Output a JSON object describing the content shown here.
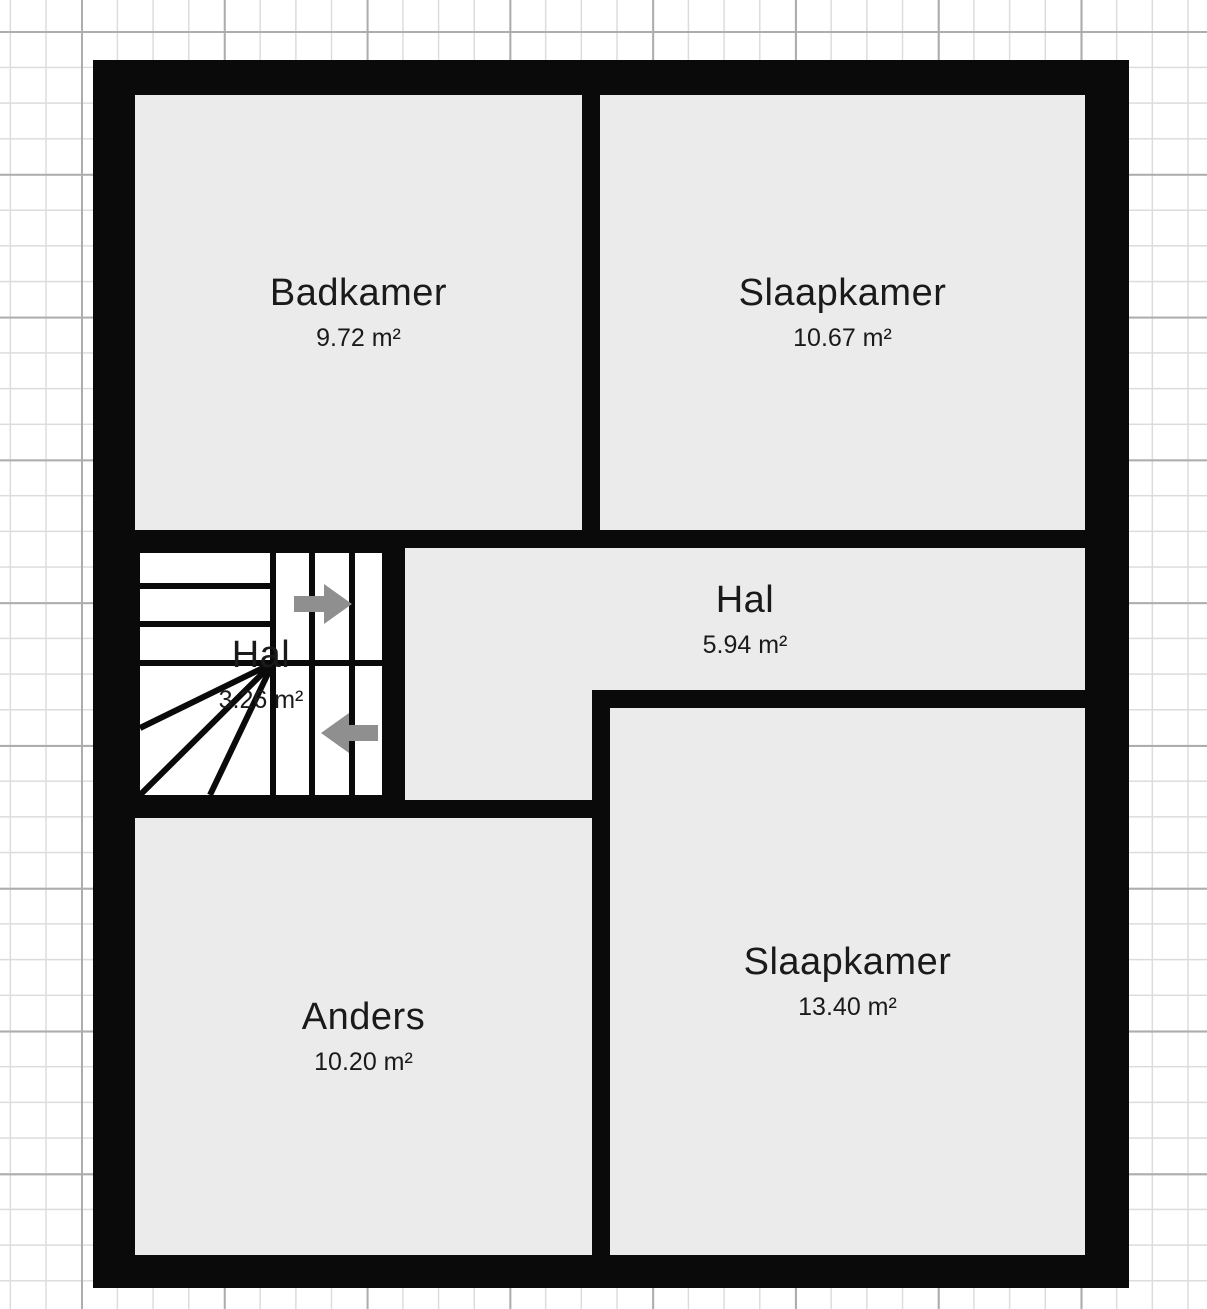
{
  "plan": {
    "kind": "floor-plan",
    "area_unit": "m²"
  },
  "rooms": [
    {
      "id": "badkamer",
      "name": "Badkamer",
      "area": "9.72 m²"
    },
    {
      "id": "slaapkamer-top",
      "name": "Slaapkamer",
      "area": "10.67 m²"
    },
    {
      "id": "hal-stairs",
      "name": "Hal",
      "area": "3.26 m²"
    },
    {
      "id": "hal",
      "name": "Hal",
      "area": "5.94 m²"
    },
    {
      "id": "anders",
      "name": "Anders",
      "area": "10.20 m²"
    },
    {
      "id": "slaapkamer-bottom",
      "name": "Slaapkamer",
      "area": "13.40 m²"
    }
  ],
  "stairs": {
    "room": "Hal",
    "area": "3.26 m²",
    "upper_flight_arrow": "right",
    "lower_flight_arrow": "left"
  },
  "colors": {
    "wall": "#0a0a0a",
    "room_fill": "#ebebeb",
    "stair_fill": "#ffffff",
    "arrow": "#8f8f8f",
    "grid_minor": "#dcdcdc",
    "grid_major": "#adadad",
    "text": "#1a1a1a",
    "background": "#ffffff"
  }
}
